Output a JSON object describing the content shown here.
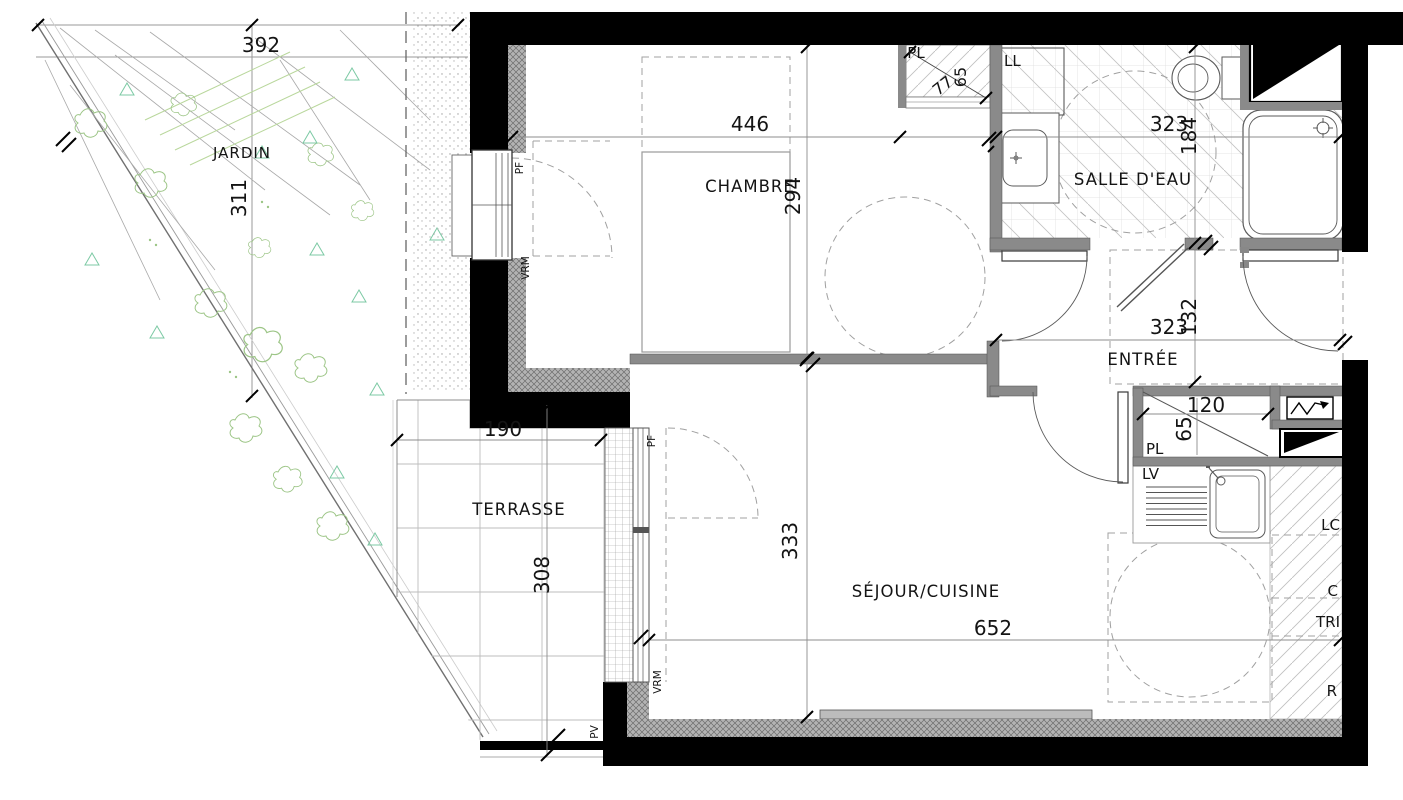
{
  "plan_type": "apartment floor plan",
  "rooms": {
    "jardin": "JARDIN",
    "terrasse": "TERRASSE",
    "chambre": "CHAMBRE",
    "salle_deau": "SALLE D'EAU",
    "entree": "ENTRÉE",
    "sejour": "SÉJOUR/CUISINE"
  },
  "dimensions_cm": {
    "jardin_w": "392",
    "jardin_h": "311",
    "chambre_w": "446",
    "chambre_h": "294",
    "salle_deau_w": "323",
    "salle_deau_h": "184",
    "entree_w": "323",
    "entree_h": "132",
    "closet_chambre_w": "77",
    "closet_chambre_d": "65",
    "closet_entree_w": "120",
    "closet_entree_d": "65",
    "terrasse_w": "190",
    "terrasse_h": "308",
    "sejour_w": "652",
    "sejour_h": "333"
  },
  "labels": {
    "closet": "PL",
    "washing_machine": "LL",
    "dishwasher": "LV",
    "laundry_column": "LC",
    "cooking": "C",
    "waste_sorting": "TRI",
    "fridge": "R",
    "french_window": "PF",
    "motorized_shutter": "VRM",
    "sliding_panel": "PV"
  },
  "colors": {
    "structural_wall": "#000000",
    "partition_wall": "#8a8a8a",
    "insulation": "#b3b3b3",
    "vegetation": "#9cc586",
    "vegetation_triangles": "#7cc9a4"
  }
}
